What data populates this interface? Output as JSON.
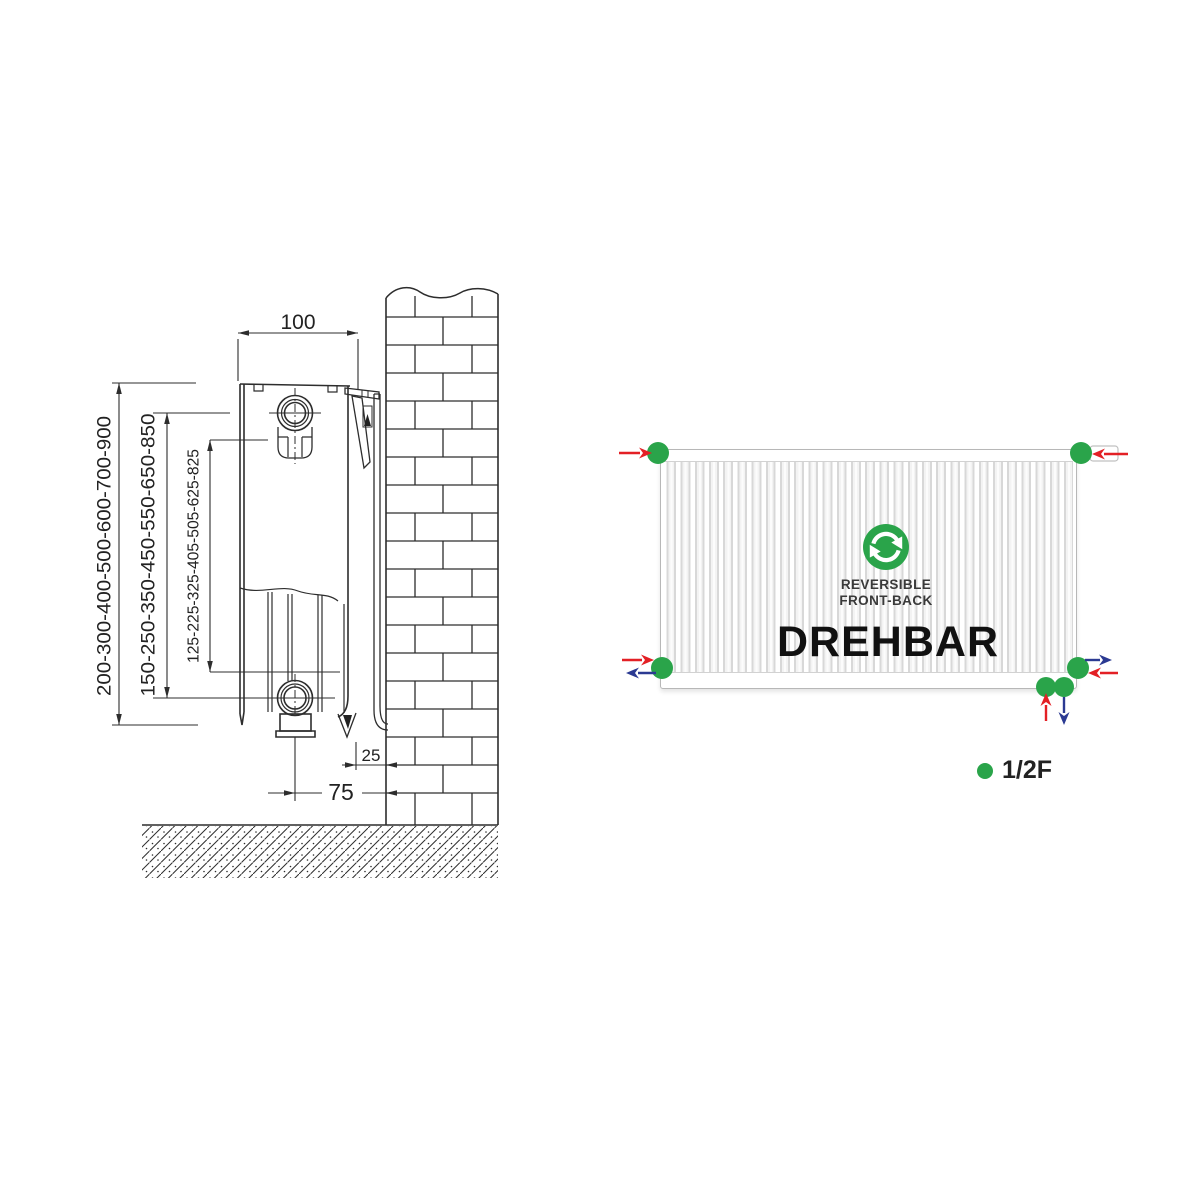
{
  "colors": {
    "green": "#2aa44a",
    "red": "#e32025",
    "blue": "#2b3a92",
    "line": "#2d2d2d"
  },
  "left_diagram": {
    "dim_depth": "100",
    "dim_heights_overall": "200-300-400-500-600-700-900",
    "dim_heights_center": "150-250-350-450-550-650-850",
    "dim_heights_bracket": "125-225-325-405-505-625-825",
    "dim_wall_gap": "25",
    "dim_pipe_to_wall": "75"
  },
  "right_diagram": {
    "badge_line1": "REVERSIBLE",
    "badge_line2": "FRONT-BACK",
    "rotatable_label": "DREHBAR",
    "legend_label": "1/2F"
  }
}
